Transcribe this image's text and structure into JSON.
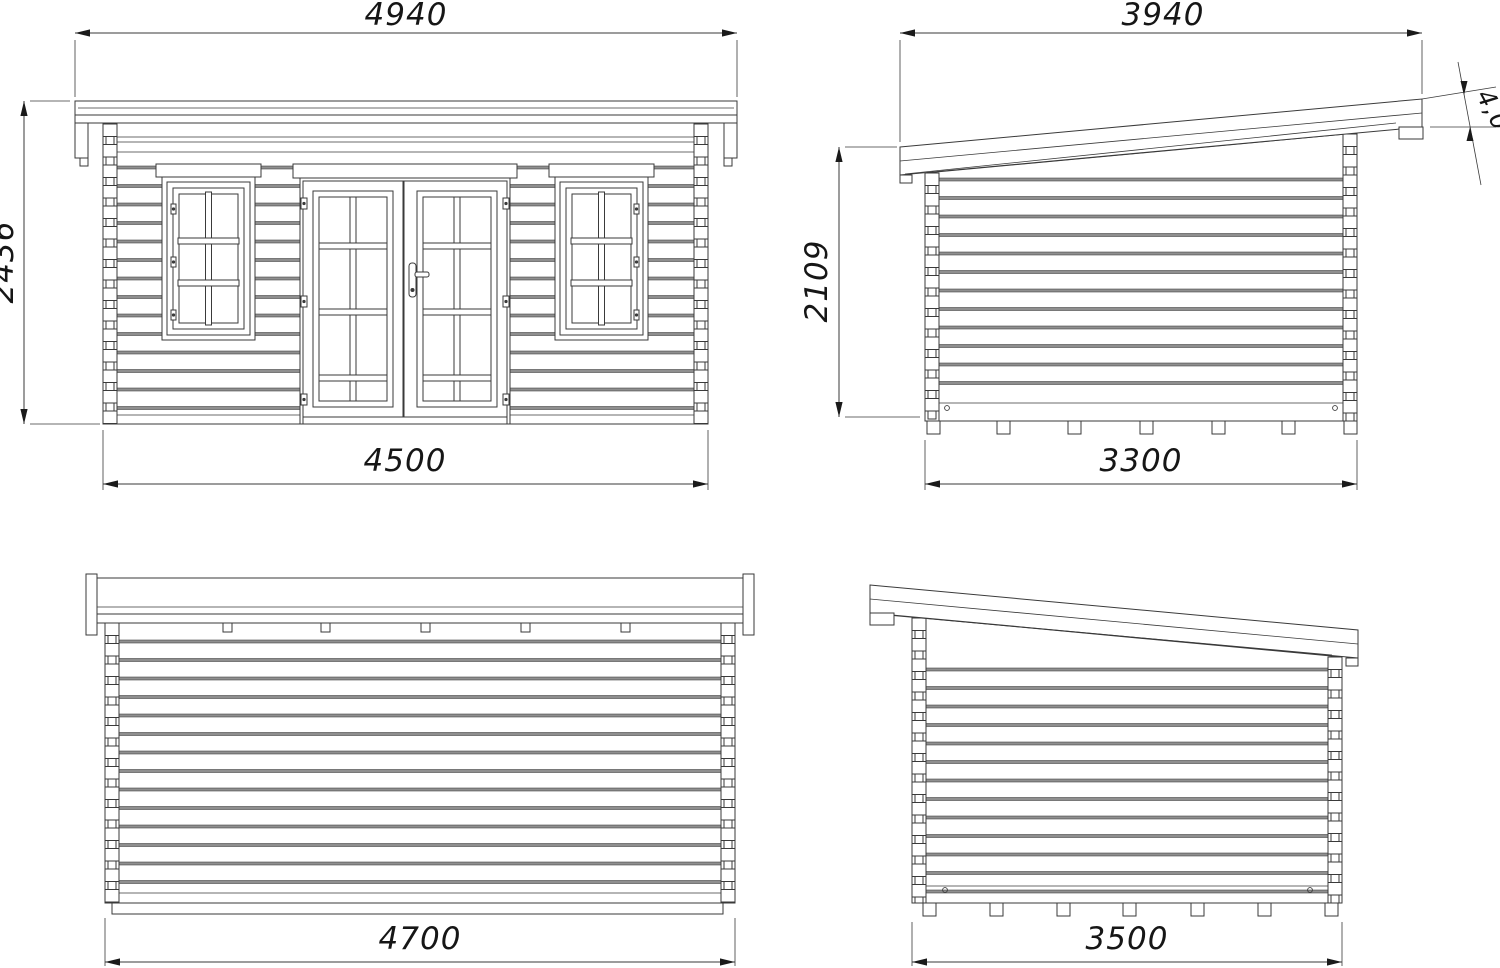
{
  "drawing": {
    "title": "log-cabin-elevation-drawing",
    "views": {
      "front": {
        "label": "front-elevation",
        "dims": {
          "overall_width": "4940",
          "height": "2436",
          "wall_width": "4500"
        }
      },
      "right_side": {
        "label": "right-side-elevation",
        "dims": {
          "overall_depth": "3940",
          "roof_angle": "4,0°",
          "height": "2109",
          "wall_depth": "3300"
        }
      },
      "rear": {
        "label": "rear-elevation",
        "dims": {
          "wall_width": "4700"
        }
      },
      "left_side": {
        "label": "left-side-elevation",
        "dims": {
          "wall_depth": "3500"
        }
      }
    },
    "colors": {
      "line": "#3a3a3a",
      "groove": "#8f8f8f",
      "dim": "#1a1a1a",
      "background": "#ffffff"
    }
  }
}
